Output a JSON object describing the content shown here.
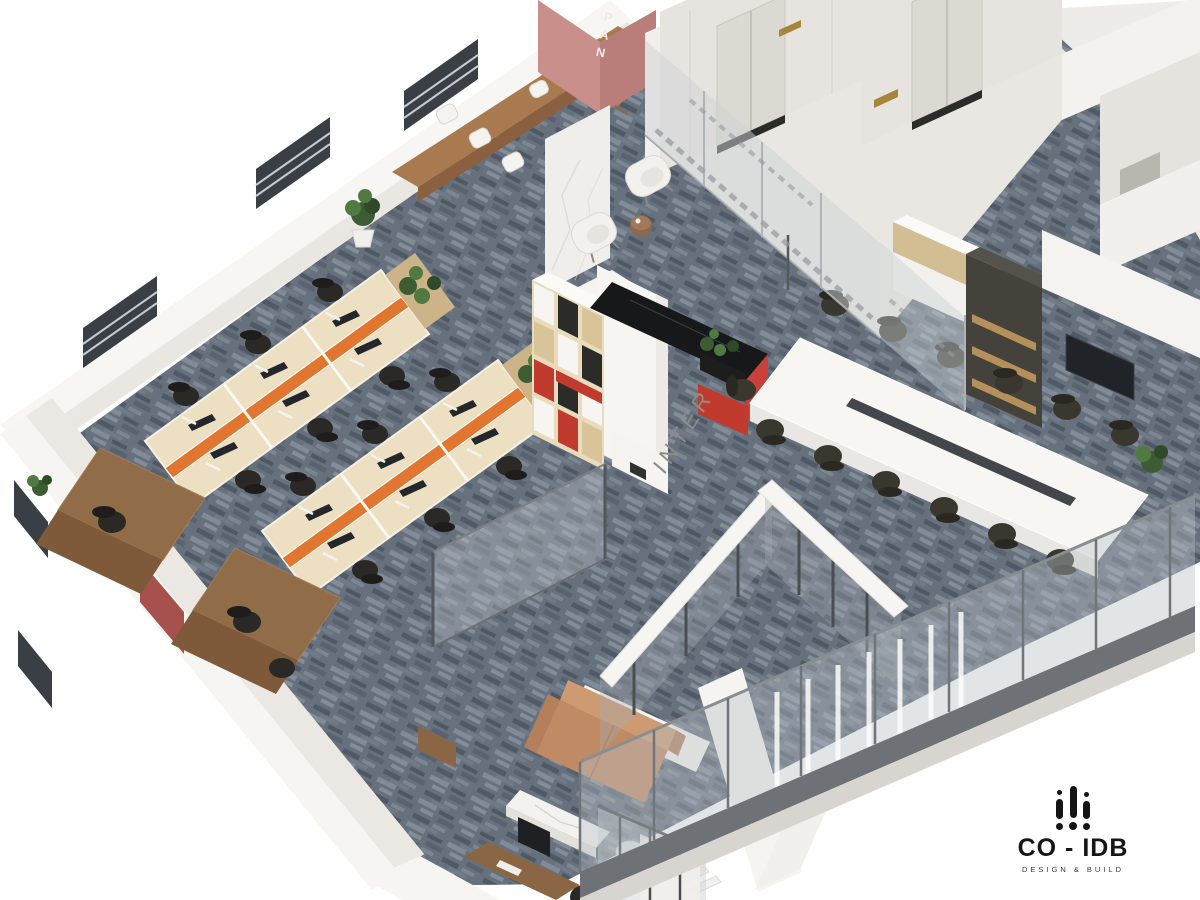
{
  "scene": {
    "description": "3D isometric cutaway render of an office interior floor plan",
    "signs": {
      "pantry": "PAN",
      "reception": "INTER"
    },
    "logo": {
      "name": "CO - IDB",
      "tagline": "DESIGN & BUILD"
    },
    "palette": {
      "background": "#ffffff",
      "carpet": "#67717e",
      "carpet_light": "#97a1ac",
      "carpet_dark": "#4e5863",
      "wall": "#f6f4f0",
      "wall_inner": "#eae7e2",
      "pink_wall": "#c98f8a",
      "pink_wall_dark": "#b97e79",
      "accent_red": "#c13a2e",
      "accent_orange": "#e0762f",
      "wood_light": "#ecdfc2",
      "wood_mid": "#d3bd92",
      "wood_walnut": "#8a6644",
      "leather_tan": "#c08a64",
      "brass_gold": "#a8853c",
      "chair_black": "#2b2926",
      "glass": "#c2c9ce",
      "counter_black": "#17181a"
    },
    "areas": [
      {
        "name": "pantry",
        "sign": "PAN",
        "features": "pink accent wall, wood bar bench, white stools"
      },
      {
        "name": "open-office",
        "features": "2 double workstation rows, orange dividers, black task chairs, walnut end desks, planters"
      },
      {
        "name": "reception",
        "sign": "INTER",
        "features": "red/black/wood cubby shelving, black stone counter, red base"
      },
      {
        "name": "waiting-area",
        "features": "2 white armchairs, round side table, marble wall"
      },
      {
        "name": "elevator-lobby",
        "elevators": 2,
        "features": "brass call panels, etched glass entry doors"
      },
      {
        "name": "conference-room",
        "seats": 13,
        "features": "long white table, wall TV, glass curtain wall"
      },
      {
        "name": "executive-office",
        "features": "tan leather sofa, marble coffee table, walnut desk, glass partitions"
      }
    ]
  }
}
